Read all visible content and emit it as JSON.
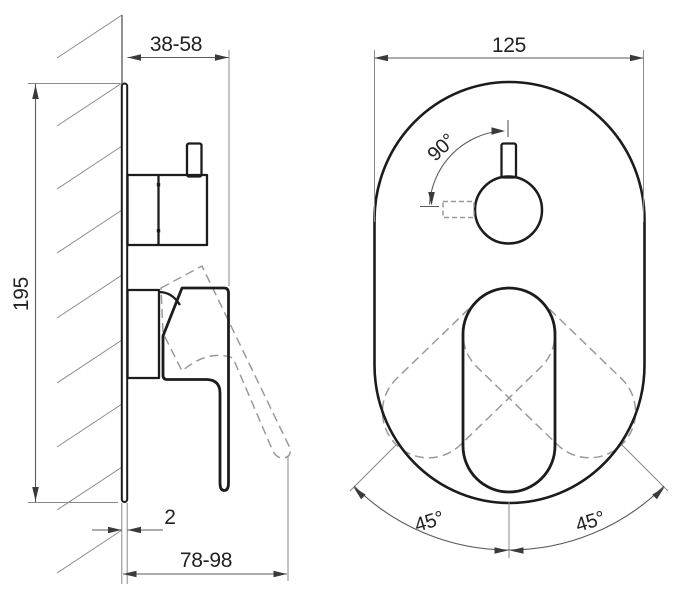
{
  "drawing": {
    "title": "concealed-shower-mixer-installation-dimensions",
    "background": "#ffffff",
    "line_color": "#1c1c1c",
    "dim_color": "#5a5a5a",
    "dash_color": "#9a9a9a",
    "side_view": {
      "handle_depth": "38-58",
      "plate_height": "195",
      "plate_thickness": "2",
      "handle_reach": "78-98"
    },
    "front_view": {
      "plate_width": "125",
      "knob_rotation": "90°",
      "lever_swing_left": "45°",
      "lever_swing_right": "45°"
    }
  }
}
